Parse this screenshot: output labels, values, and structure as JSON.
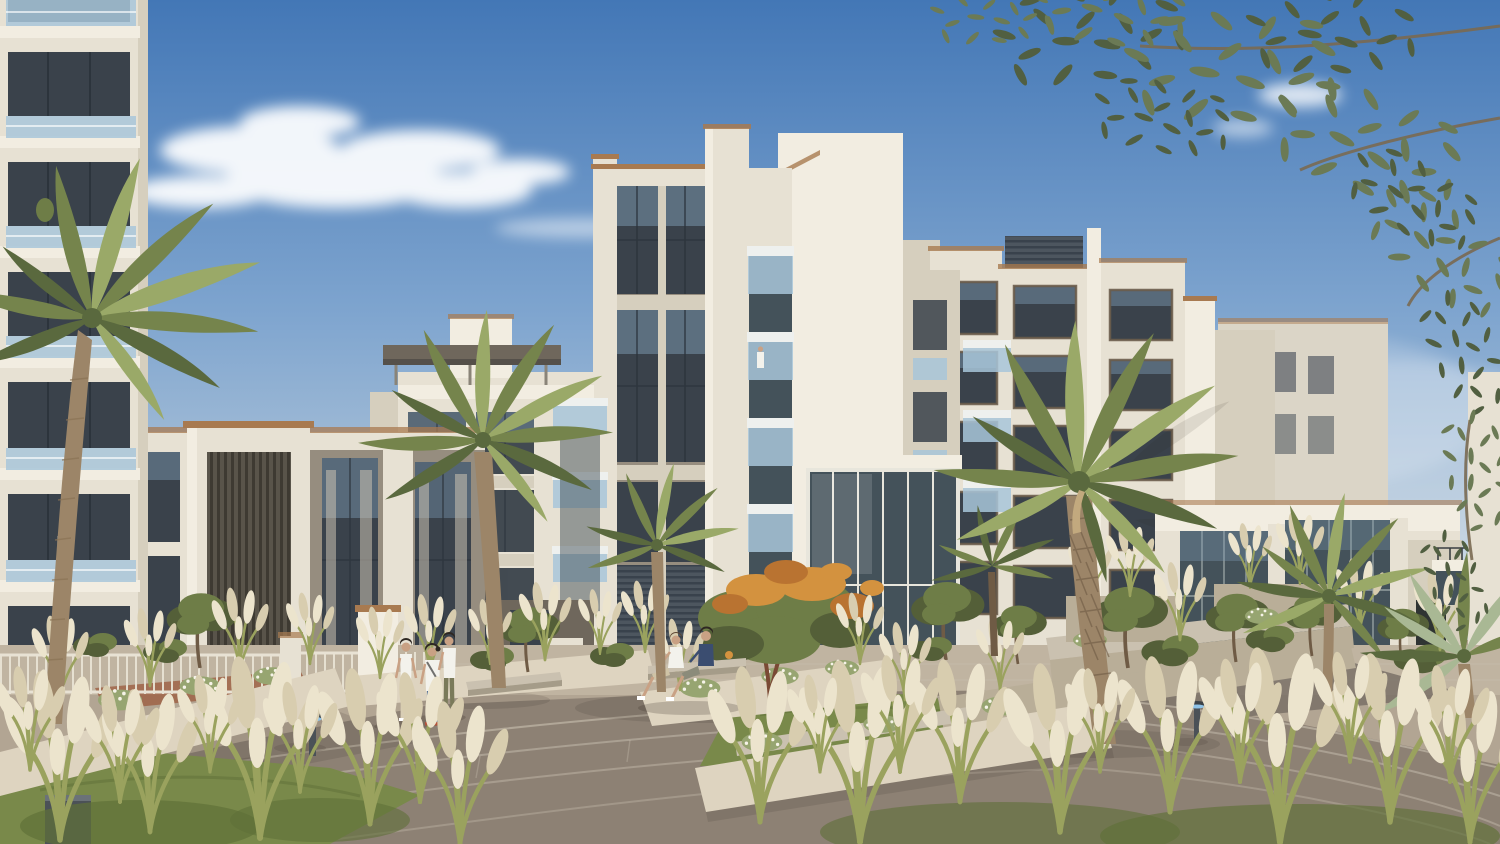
{
  "scene": {
    "type": "architectural-exterior-render",
    "setting": "modern cream low-rise apartment community with landscaped palm plaza, boardwalk, pampas grass planters and an orange flowering tree under a sunny blue sky",
    "people": [
      "three residents standing on the boardwalk",
      "two residents sitting on a planter bench",
      "tiny figure on a balcony"
    ],
    "time_of_day": "day"
  },
  "colors": {
    "sky_top": "#4377b6",
    "sky_mid": "#7fa5cf",
    "sky_low": "#b6c9da",
    "sky_horizon": "#dde2e3",
    "cloud": "#ffffff",
    "white_hi": "#f2ede1",
    "cream": "#e7e1d3",
    "cream_shade": "#d6cfbe",
    "tan": "#c9c0ab",
    "gray_panel": "#968d7f",
    "gray_dark": "#6f675c",
    "glass_dark": "#3a424b",
    "glass_teal": "#44525a",
    "glass_blue": "#7e9cb4",
    "rail_blue": "#a8c5d9",
    "rail_white": "#eef0ee",
    "louver": "#4d565f",
    "coping": "#a87a50",
    "plaza": "#b2a593",
    "plaza_light": "#c0b4a1",
    "deck": "#8d8174",
    "deck_line": "#cfc6b7",
    "asphalt": "#756d64",
    "wall_light": "#ded4c0",
    "wall_shade": "#b9ae98",
    "mulch": "#9c5f42",
    "lawn": "#79894a",
    "lawn_dark": "#5f7038",
    "stem": "#9aa25e",
    "plume": "#ece4cd",
    "plume2": "#d8cdaf",
    "palm1": "#9aa968",
    "palm2": "#75844c",
    "palm3": "#5a693e",
    "palm_silver": "#a9b894",
    "euc1": "#6b7a55",
    "euc2": "#515f41",
    "tree1": "#6e7d47",
    "tree2": "#545f38",
    "sage": "#97a571",
    "orange1": "#d3923f",
    "orange2": "#b97331",
    "trunk1": "#9c8568",
    "trunk2": "#6f5b45",
    "bench": "#cac1b0",
    "bench_shade": "#a59c89",
    "metal": "#4b5157",
    "light_glow": "#8fc3e8",
    "skin": "#c9a184",
    "shirt_white": "#f3f2ec",
    "jeans": "#4d6c98",
    "navy": "#3b4d70",
    "pants_beige": "#d8cdb4",
    "pants_olive": "#7a7a5a",
    "shorts_tan": "#cfc3a6"
  }
}
